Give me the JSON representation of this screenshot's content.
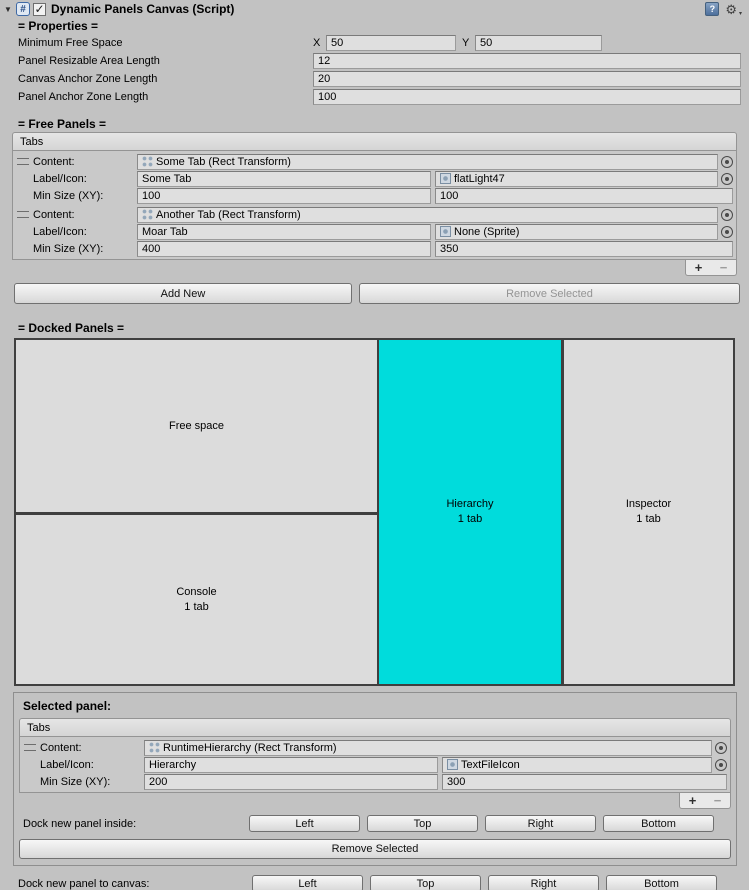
{
  "icons": {
    "foldout": "▼",
    "script": "#",
    "check": "✓",
    "help": "?",
    "gear": "⚙",
    "gear_caret": "▾"
  },
  "header": {
    "title": "Dynamic Panels Canvas (Script)"
  },
  "labels": {
    "tabs": "Tabs",
    "content": "Content:",
    "label_icon": "Label/Icon:",
    "min_size": "Min Size (XY):",
    "plus": "+",
    "minus": "−"
  },
  "properties": {
    "section_title": "= Properties =",
    "minimum_free_space": {
      "label": "Minimum Free Space",
      "x_label": "X",
      "x_value": "50",
      "y_label": "Y",
      "y_value": "50"
    },
    "panel_resizable_area_length": {
      "label": "Panel Resizable Area Length",
      "value": "12"
    },
    "canvas_anchor_zone_length": {
      "label": "Canvas Anchor Zone Length",
      "value": "20"
    },
    "panel_anchor_zone_length": {
      "label": "Panel Anchor Zone Length",
      "value": "100"
    }
  },
  "free_panels": {
    "section_title": "= Free Panels =",
    "items": [
      {
        "content": "Some Tab (Rect Transform)",
        "label": "Some Tab",
        "icon": "flatLight47",
        "min_x": "100",
        "min_y": "100"
      },
      {
        "content": "Another Tab (Rect Transform)",
        "label": "Moar Tab",
        "icon": "None (Sprite)",
        "min_x": "400",
        "min_y": "350"
      }
    ],
    "add_new": "Add New",
    "remove_selected": "Remove Selected"
  },
  "docked_panels": {
    "section_title": "= Docked Panels =",
    "selected_color": "#00dcdc",
    "free_space": {
      "label": "Free space"
    },
    "console": {
      "label": "Console",
      "tabs": "1 tab"
    },
    "hierarchy": {
      "label": "Hierarchy",
      "tabs": "1 tab"
    },
    "inspector": {
      "label": "Inspector",
      "tabs": "1 tab"
    }
  },
  "selected_panel": {
    "title": "Selected panel:",
    "item": {
      "content": "RuntimeHierarchy (Rect Transform)",
      "label": "Hierarchy",
      "icon": "TextFileIcon",
      "min_x": "200",
      "min_y": "300"
    },
    "dock_inside_label": "Dock new panel inside:",
    "dock_buttons": {
      "left": "Left",
      "top": "Top",
      "right": "Right",
      "bottom": "Bottom"
    },
    "remove_selected": "Remove Selected"
  },
  "dock_canvas": {
    "label": "Dock new panel to canvas:",
    "buttons": {
      "left": "Left",
      "top": "Top",
      "right": "Right",
      "bottom": "Bottom"
    }
  }
}
